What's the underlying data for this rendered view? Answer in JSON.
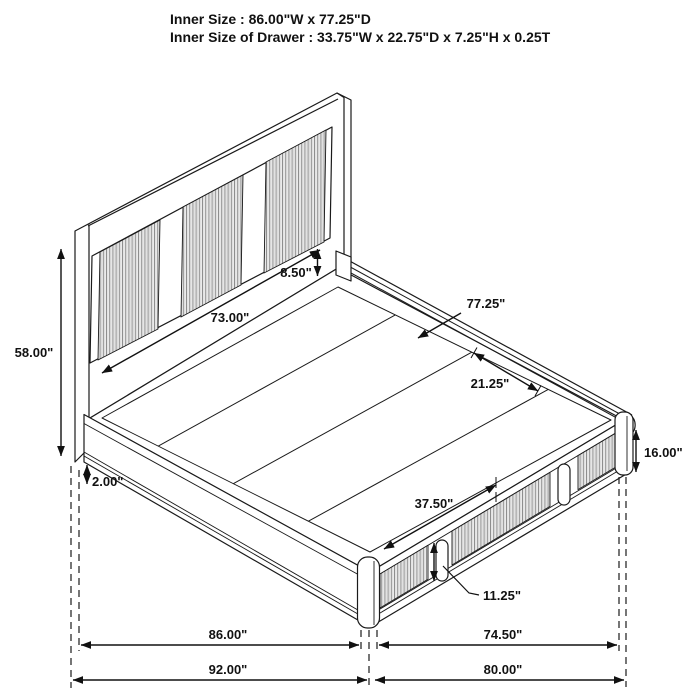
{
  "title": {
    "line1": "Inner Size : 86.00\"W x 77.25\"D",
    "line2": "Inner Size of Drawer : 33.75\"W x 22.75\"D x 7.25\"H x 0.25T"
  },
  "dimensions": {
    "headboard_height": "58.00\"",
    "headboard_rail_height": "8.50\"",
    "headboard_inner_width": "73.00\"",
    "platform_inner_depth": "77.25\"",
    "deck_panel_depth": "21.25\"",
    "footboard_height": "16.00\"",
    "base_clearance": "2.00\"",
    "drawer_front_width": "37.50\"",
    "drawer_handle_height": "11.25\"",
    "bottom_width_inner": "86.00\"",
    "bottom_depth_inner": "74.50\"",
    "bottom_width_overall": "92.00\"",
    "bottom_depth_overall": "80.00\""
  },
  "colors": {
    "line": "#1a1a1a",
    "background": "#ffffff",
    "slat_line": "#8a8a8a"
  }
}
